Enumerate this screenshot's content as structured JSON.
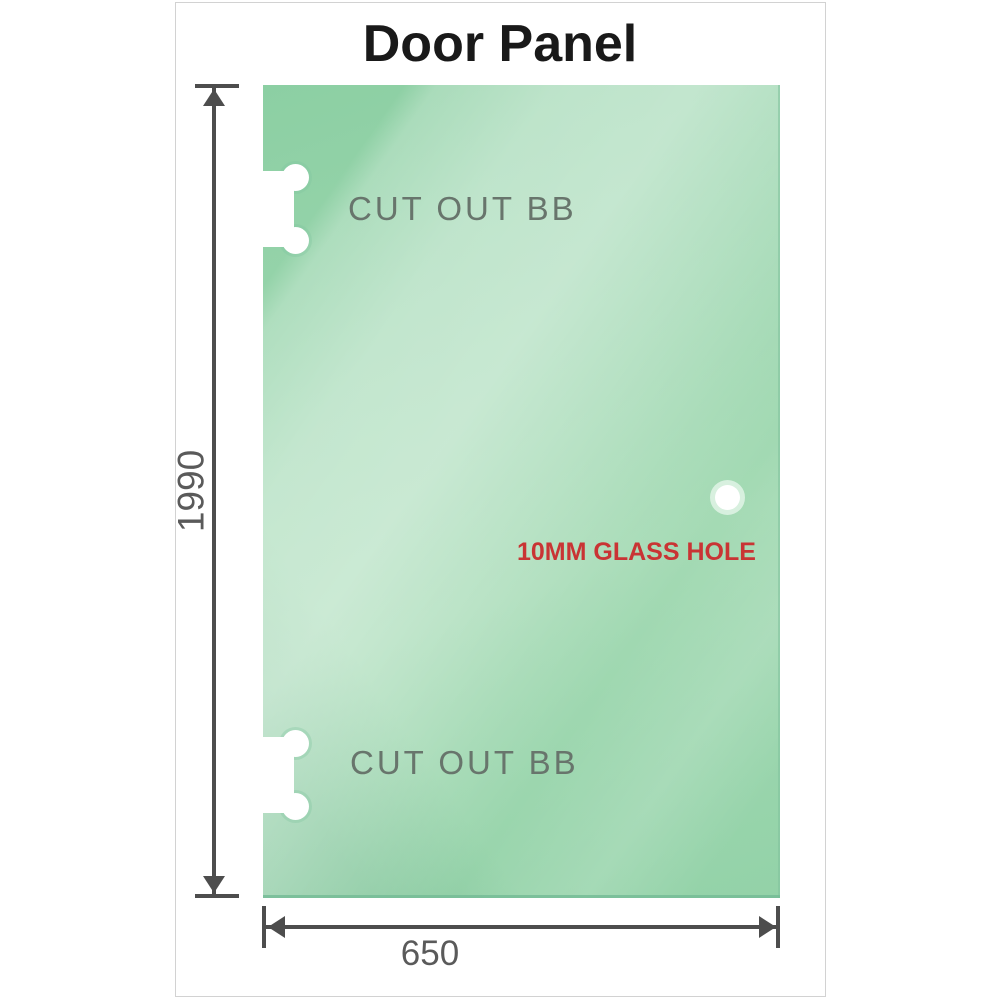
{
  "title": "Door Panel",
  "diagram": {
    "panel": {
      "description": "glass door panel",
      "glass_color_base": "#9bd6ae",
      "glass_color_light": "#cdeccf"
    },
    "cutouts": [
      {
        "label": "CUT OUT BB",
        "position": "top-left"
      },
      {
        "label": "CUT OUT BB",
        "position": "bottom-left"
      }
    ],
    "hole": {
      "label": "10MM GLASS HOLE",
      "label_color": "#c93434"
    },
    "dimensions": {
      "height": {
        "value": "1990",
        "orientation": "vertical"
      },
      "width": {
        "value": "650",
        "orientation": "horizontal"
      }
    }
  },
  "colors": {
    "dimension_lines": "#4d4d4d",
    "dimension_text": "#5a5a5a",
    "cutout_text": "#68756c",
    "title_text": "#191919",
    "card_border": "#d2d2d2",
    "background": "#ffffff"
  }
}
